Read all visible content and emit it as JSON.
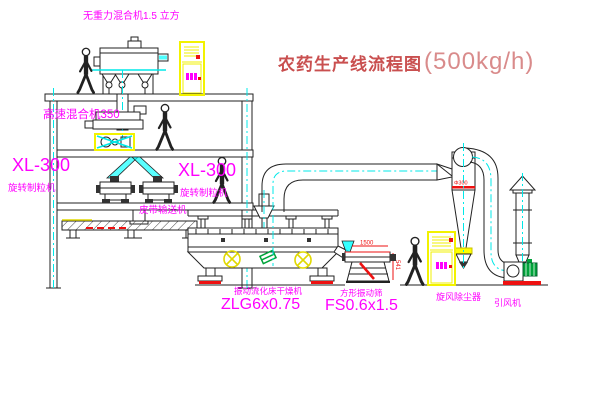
{
  "title": {
    "main": "农药生产线流程图",
    "capacity": "(500kg/h)"
  },
  "equipment_labels": {
    "zero_gravity_mixer": "无重力混合机1.5 立方",
    "high_speed_mixer": "高速混合机350",
    "granulator_left": {
      "model": "XL-300",
      "name": "旋转制粒机"
    },
    "granulator_right": {
      "model": "XL-300",
      "name": "旋转制粒机"
    },
    "belt_conveyor": "皮带输送机",
    "fluid_bed_dryer": {
      "name": "振动流化床干燥机",
      "model": "ZLG6x0.75"
    },
    "vibrating_sieve": {
      "name": "方形振动筛",
      "model": "FS0.6x1.5"
    },
    "cyclone_dust_collector": "旋风除尘器",
    "induced_draft_fan": "引风机"
  },
  "dimensions": {
    "sieve_length": "1500",
    "sieve_height": "541",
    "cyclone_note": "Φ300"
  },
  "colors": {
    "label_magenta": "#ff00ff",
    "centerline_cyan": "#00e8e8",
    "cabinet_yellow": "#f2f200",
    "dim_red": "#ee1111",
    "title_red": "#c94f4f",
    "title_light_red": "#d98b8b",
    "line": "#222222",
    "motor_green": "#00a33a"
  }
}
